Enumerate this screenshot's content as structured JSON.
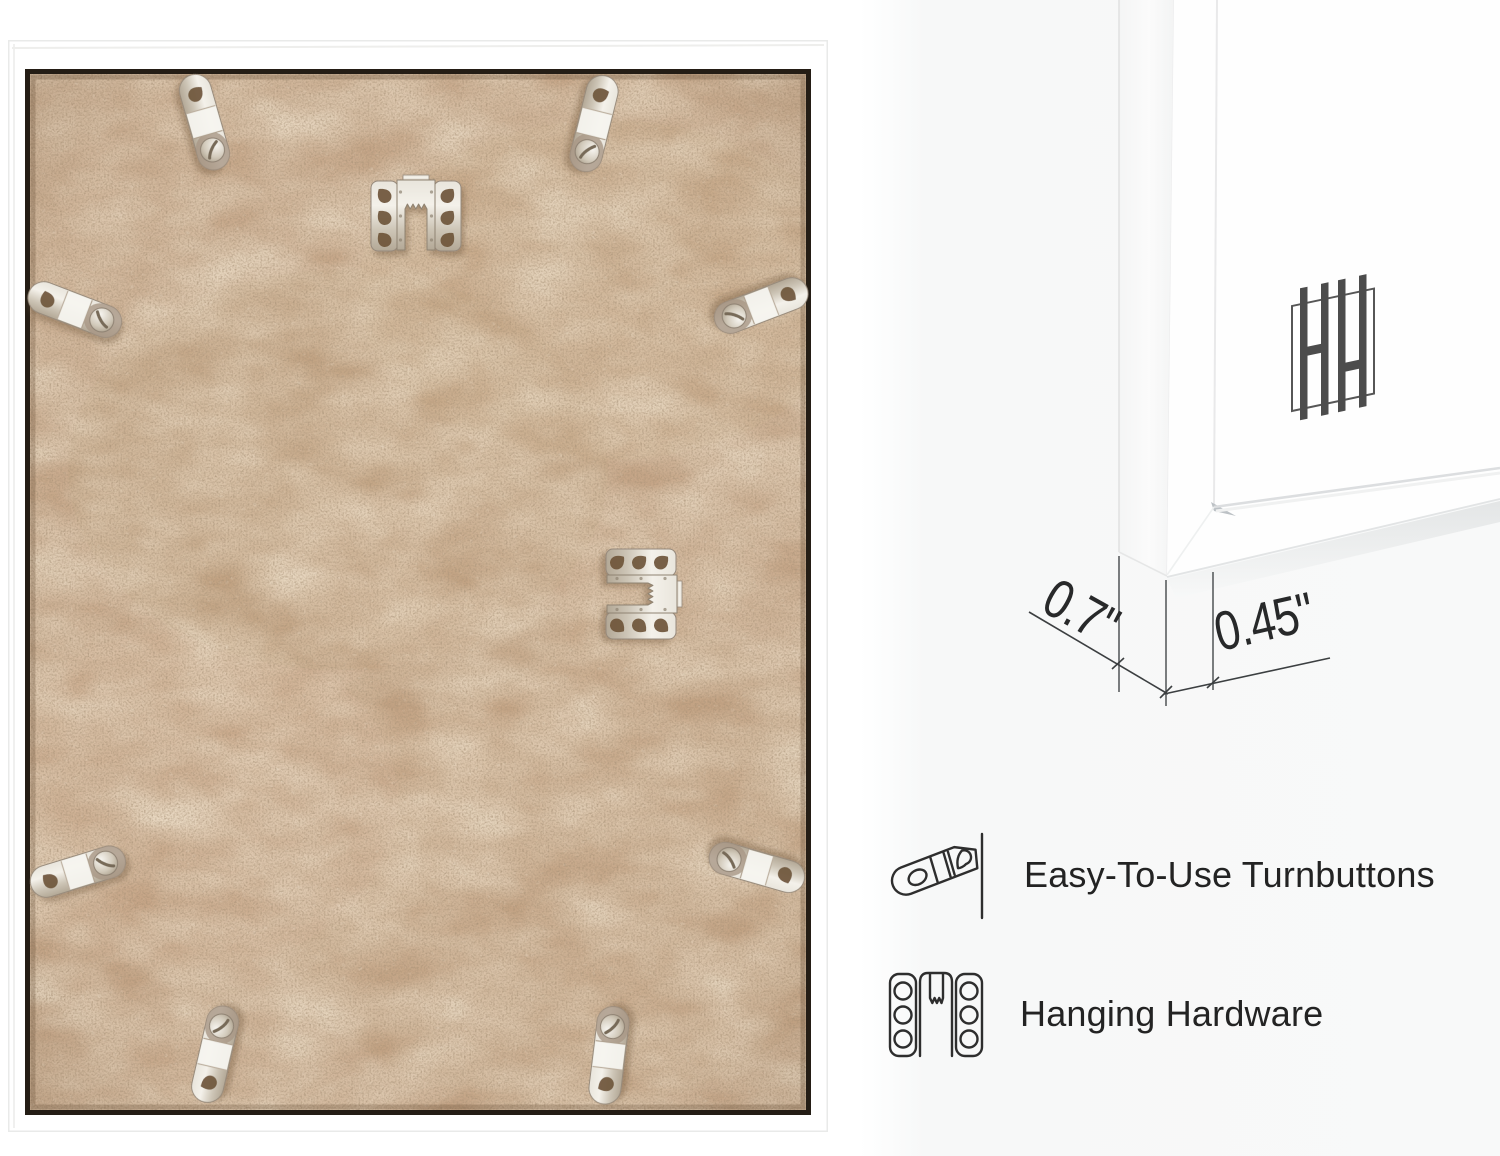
{
  "page": {
    "type": "product-infographic-picture-frame",
    "colors": {
      "board": "#c8a88a",
      "frame_white": "#ffffff",
      "metal": "#d8d2c6",
      "line_art": "#2f2f2f",
      "dimension_lines": "#55595c",
      "text": "#232323",
      "background_right": "#f8f9f9"
    }
  },
  "back_photo": {
    "name": "frame-back-view",
    "turnbutton_count": 8,
    "sawtooth_hanger_count": 2
  },
  "corner_photo": {
    "name": "frame-corner-front-view",
    "logo_monogram": "HH"
  },
  "dimensions": {
    "depth": "0.7\"",
    "moulding_width": "0.45\""
  },
  "features": [
    {
      "icon": "turnbutton-icon",
      "label": "Easy-To-Use Turnbuttons"
    },
    {
      "icon": "hanging-hardware-icon",
      "label": "Hanging Hardware"
    }
  ]
}
